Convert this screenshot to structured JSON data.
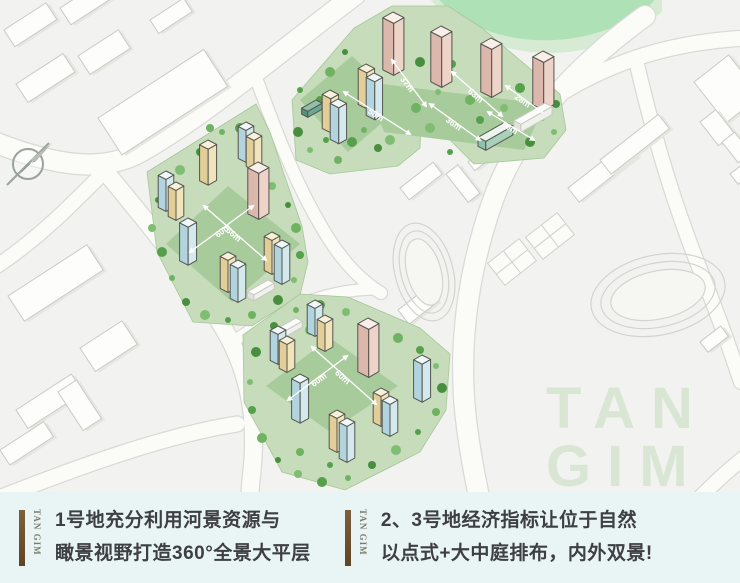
{
  "map": {
    "dims": [
      "37m",
      "58m",
      "63m",
      "36m",
      "28m",
      "50m",
      "60m",
      "66m",
      "60m",
      "60m"
    ],
    "watermark": {
      "line1": "TAN",
      "line2": "GIM"
    },
    "colors": {
      "lawn_light": "#c6dcba",
      "lawn_court": "#a8cb9c",
      "tree_green": "#58a14e",
      "river_green": "#aee1b6",
      "tower_pink": "#eed3c9",
      "tower_yellow": "#f1e4ba",
      "tower_blue": "#d3e9ee",
      "podium_teal": "#6aa892",
      "caption_bg": "#e9f4f5",
      "brand_bar_brown": "#6e5336",
      "watermark_green": "#d9e6d4"
    }
  },
  "captions": [
    {
      "brand": "TAN GIM",
      "line1": "1号地充分利用河景资源与",
      "line2": "瞰景视野打造360°全景大平层"
    },
    {
      "brand": "TAN GIM",
      "line1": "2、3号地经济指标让位于自然",
      "line2": "以点式+大中庭排布，内外双景!"
    }
  ]
}
